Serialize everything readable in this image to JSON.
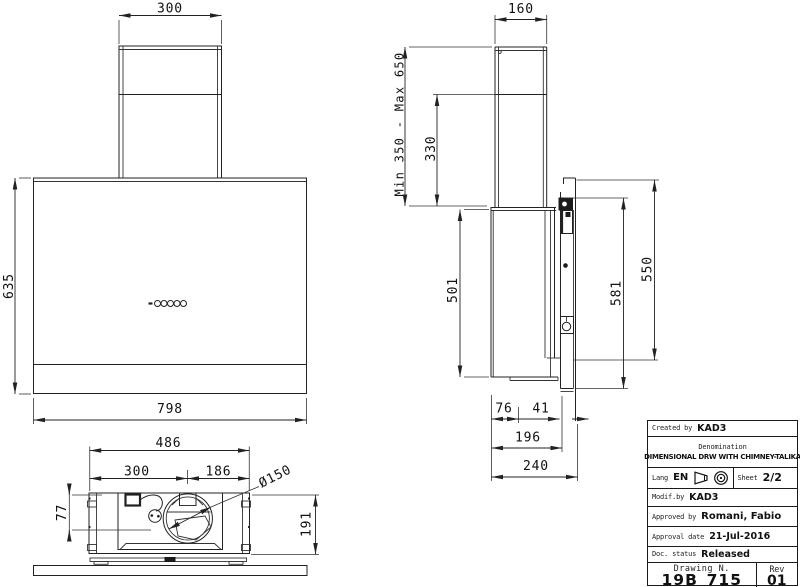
{
  "front_view": {
    "dim_chimney_width": "300",
    "dim_height": "635",
    "dim_width": "798"
  },
  "bottom_view": {
    "dim_width": "486",
    "dim_left_to_duct": "300",
    "dim_duct_to_right": "186",
    "dim_duct_diameter": "Ø150",
    "dim_gland_offset": "77",
    "dim_depth": "191"
  },
  "side_view": {
    "dim_chimney_depth": "160",
    "dim_mounting_range": "Min 350 - Max 650",
    "dim_lower_chimney": "330",
    "dim_body_front_height": "501",
    "dim_bracket_height": "581",
    "dim_back_height": "550",
    "dim_depth_front": "76",
    "dim_depth_gap": "41",
    "dim_depth_body": "196",
    "dim_depth_total": "240"
  },
  "title_block": {
    "created_by_label": "Created by",
    "created_by": "KAD3",
    "denomination_label": "Denomination",
    "denomination": "DIMENSIONAL DRW WITH CHIMNEY-TALIKA",
    "lang_label": "Lang",
    "lang": "EN",
    "sheet_label": "Sheet",
    "sheet": "2/2",
    "modif_label": "Modif.by",
    "modif_by": "KAD3",
    "approved_label": "Approved by",
    "approved_by": "Romani, Fabio",
    "approval_date_label": "Approval date",
    "approval_date": "21-Jul-2016",
    "doc_status_label": "Doc. status",
    "doc_status": "Released",
    "drawing_n_label": "Drawing N.",
    "drawing_n": "19B_715",
    "rev_label": "Rev",
    "rev": "01"
  }
}
